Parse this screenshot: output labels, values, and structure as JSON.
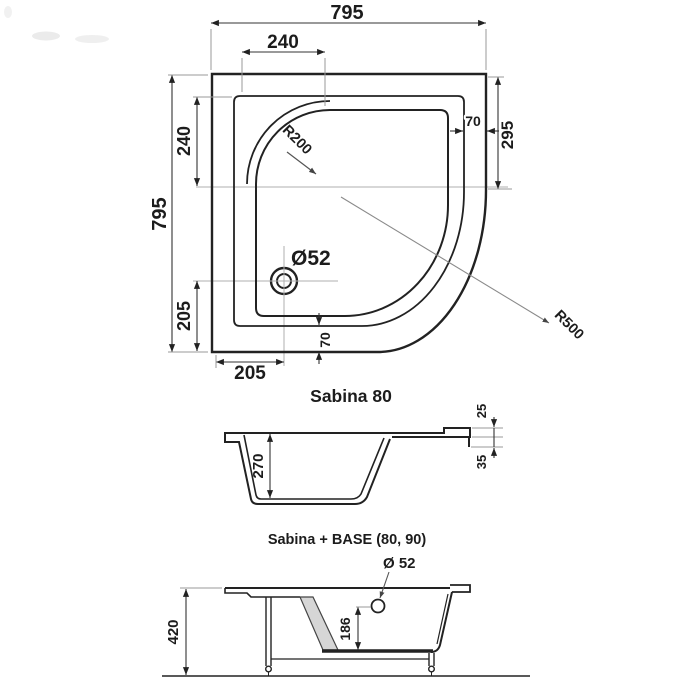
{
  "colors": {
    "line": "#222222",
    "thin_gray": "#a8a8a8",
    "hatch_fill": "#d6d6d6",
    "background": "#ffffff"
  },
  "top_view": {
    "dim_width_top": "795",
    "dim_height_left": "795",
    "dim_seat_width": "240",
    "dim_seat_height": "240",
    "dim_drain_from_left": "205",
    "dim_drain_from_bottom": "205",
    "dim_right_straight": "295",
    "dim_rim_right": "70",
    "dim_rim_bottom": "70",
    "radius_seat": "R200",
    "radius_front": "R500",
    "drain_label": "Ø52"
  },
  "side_view": {
    "title": "Sabina 80",
    "dim_depth": "270",
    "dim_rim_top": "25",
    "dim_rim_edge": "35"
  },
  "base_view": {
    "title": "Sabina + BASE (80, 90)",
    "drain_label": "Ø 52",
    "dim_total_height": "420",
    "dim_drain_height": "186"
  }
}
